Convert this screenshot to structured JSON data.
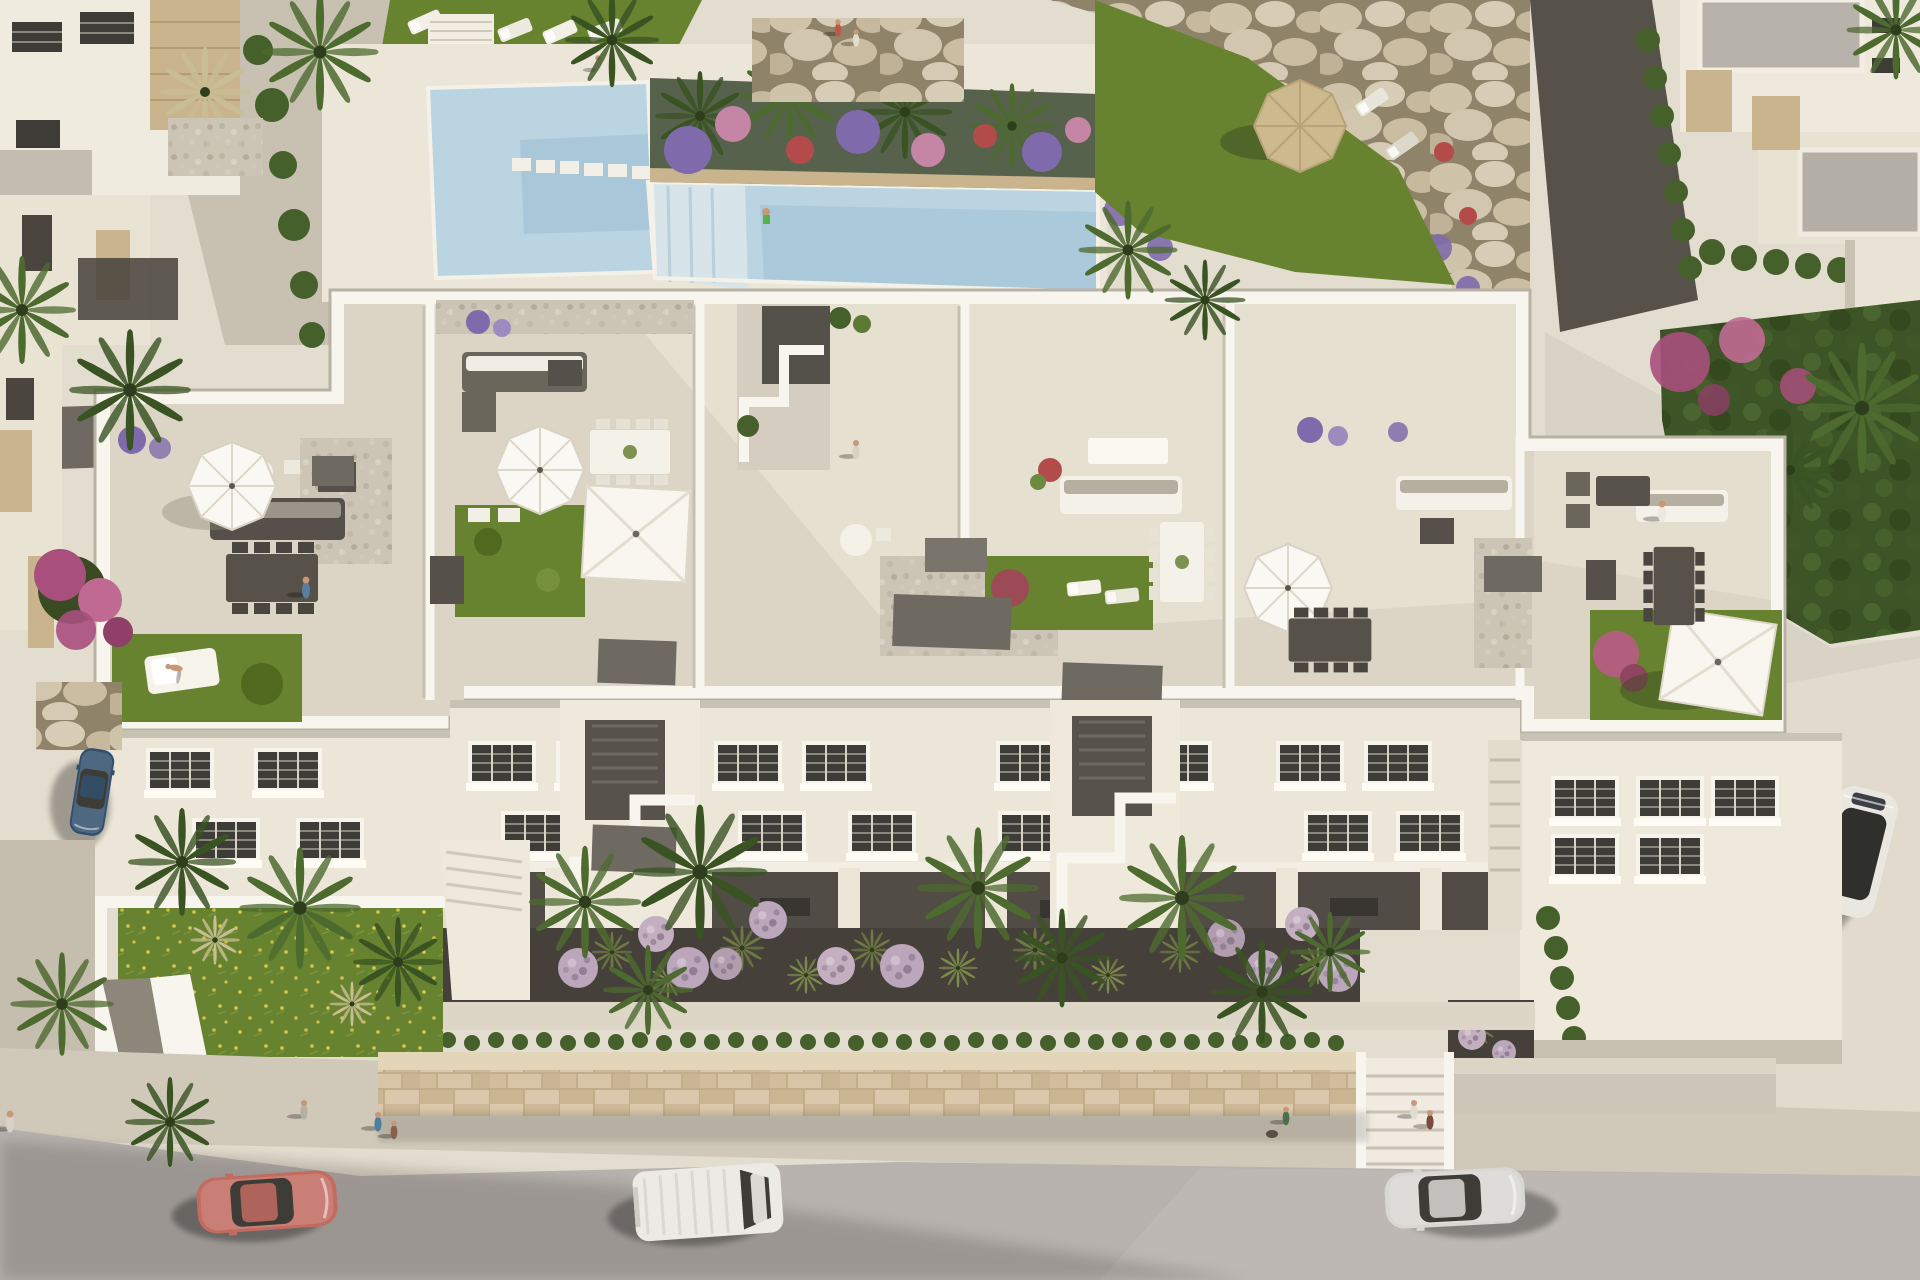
{
  "meta": {
    "description": "Photorealistic aerial 3D rendering of a white Mediterranean apartment complex with rooftop terraces, roof gardens, a communal swimming pool, landscaped front gardens with lavender balls and palm trees, and a street with parked and passing cars and pedestrians",
    "view": "high-angle aerial, late-afternoon sun from the right casting long shadows to the lower-left",
    "contains_text": "none"
  },
  "palette": {
    "deck": "#e3ddcf",
    "deck2": "#ece6d8",
    "path": "#c8c1b2",
    "roof": "#dcd5c6",
    "roofsun": "#eae4d5",
    "white": "#f8f5ee",
    "parashade": "#c3bcad",
    "facade": "#ece6d8",
    "facadeshade": "#d9d2c2",
    "glass": "#3e3c37",
    "lawn": "#67832f",
    "lawndark": "#50691f",
    "pool": "#bad4e2",
    "pooldeep": "#9cc0d3",
    "poolstep": "#d7e5eb",
    "pebble": "#ccc5b6",
    "bed": "#45413a",
    "rockbg": "#8f8369",
    "hedge": "#46602c",
    "palm1": "#4d6a2f",
    "palm2": "#3a5323",
    "olive": "#6d7a41",
    "pampas": "#c8bd93",
    "lavender": "#bca6bb",
    "lavdark": "#6e5d73",
    "bougain": "#a84f7d",
    "redflower": "#b34b4b",
    "purpleflower": "#7f6bab",
    "pinkflower": "#c585a5",
    "stonewall": "#d4c1a2",
    "concrete": "#cdc6b8",
    "sidewalk": "#d0c9b9",
    "street": "#b7b2ae",
    "streetlight": "#c2bdb8",
    "shadow": "#55514b",
    "carred": "#c26b60",
    "carblue": "#32506e",
    "carsilver": "#d8d7d3",
    "vanwhite": "#eceae5",
    "suvwhite": "#e9e7e0",
    "furndark": "#55514a",
    "furngray": "#8e887c",
    "slab": "#6e6a62",
    "skin": "#c79878",
    "strawtop": "#cdb98e",
    "stone": "#c9b48e",
    "grayroof": "#b7b2aa"
  },
  "scene": {
    "upper_area": {
      "items": [
        "neighbor villas with sandstone accents",
        "communal swimming pool with stepping stones",
        "flower planter island with palms",
        "sun lounger lawn",
        "boulder retaining walls",
        "straw parasol with loungers",
        "neighbor houses with flat gray roofs"
      ]
    },
    "building": {
      "type": "white three-storey apartment block",
      "rooftop": [
        "octagonal white parasols",
        "square white sail parasols",
        "outdoor sofas",
        "dining tables with chairs",
        "roof lawns with daybeds",
        "pebble patches",
        "planters with purple and red flowers",
        "stair towers"
      ],
      "facade": [
        "two rows of louvered windows",
        "recessed ground-floor patios",
        "zigzag exterior stairs"
      ]
    },
    "front_garden": {
      "items": [
        "dark gravel beds",
        "round lavender shrubs",
        "ornamental grasses",
        "tall palm trees",
        "wildflower lawn",
        "white garden walls"
      ]
    },
    "street": {
      "vehicles": [
        {
          "name": "coral-sedan",
          "color": "#c26b60",
          "state": "driving, lower left"
        },
        {
          "name": "white-van",
          "color": "#eceae5",
          "state": "driving, bottom center"
        },
        {
          "name": "silver-sedan",
          "color": "#d8d7d3",
          "state": "driving, lower right"
        },
        {
          "name": "white-suv-dark-roof",
          "color": "#e9e7e0",
          "state": "parked on right driveway"
        },
        {
          "name": "blue-sedan",
          "color": "#32506e",
          "state": "parked at left kerb"
        }
      ],
      "infrastructure": [
        "sandstone boundary wall",
        "low hedge",
        "sidewalk",
        "entrance stairs"
      ],
      "pedestrians_count": 12
    }
  }
}
